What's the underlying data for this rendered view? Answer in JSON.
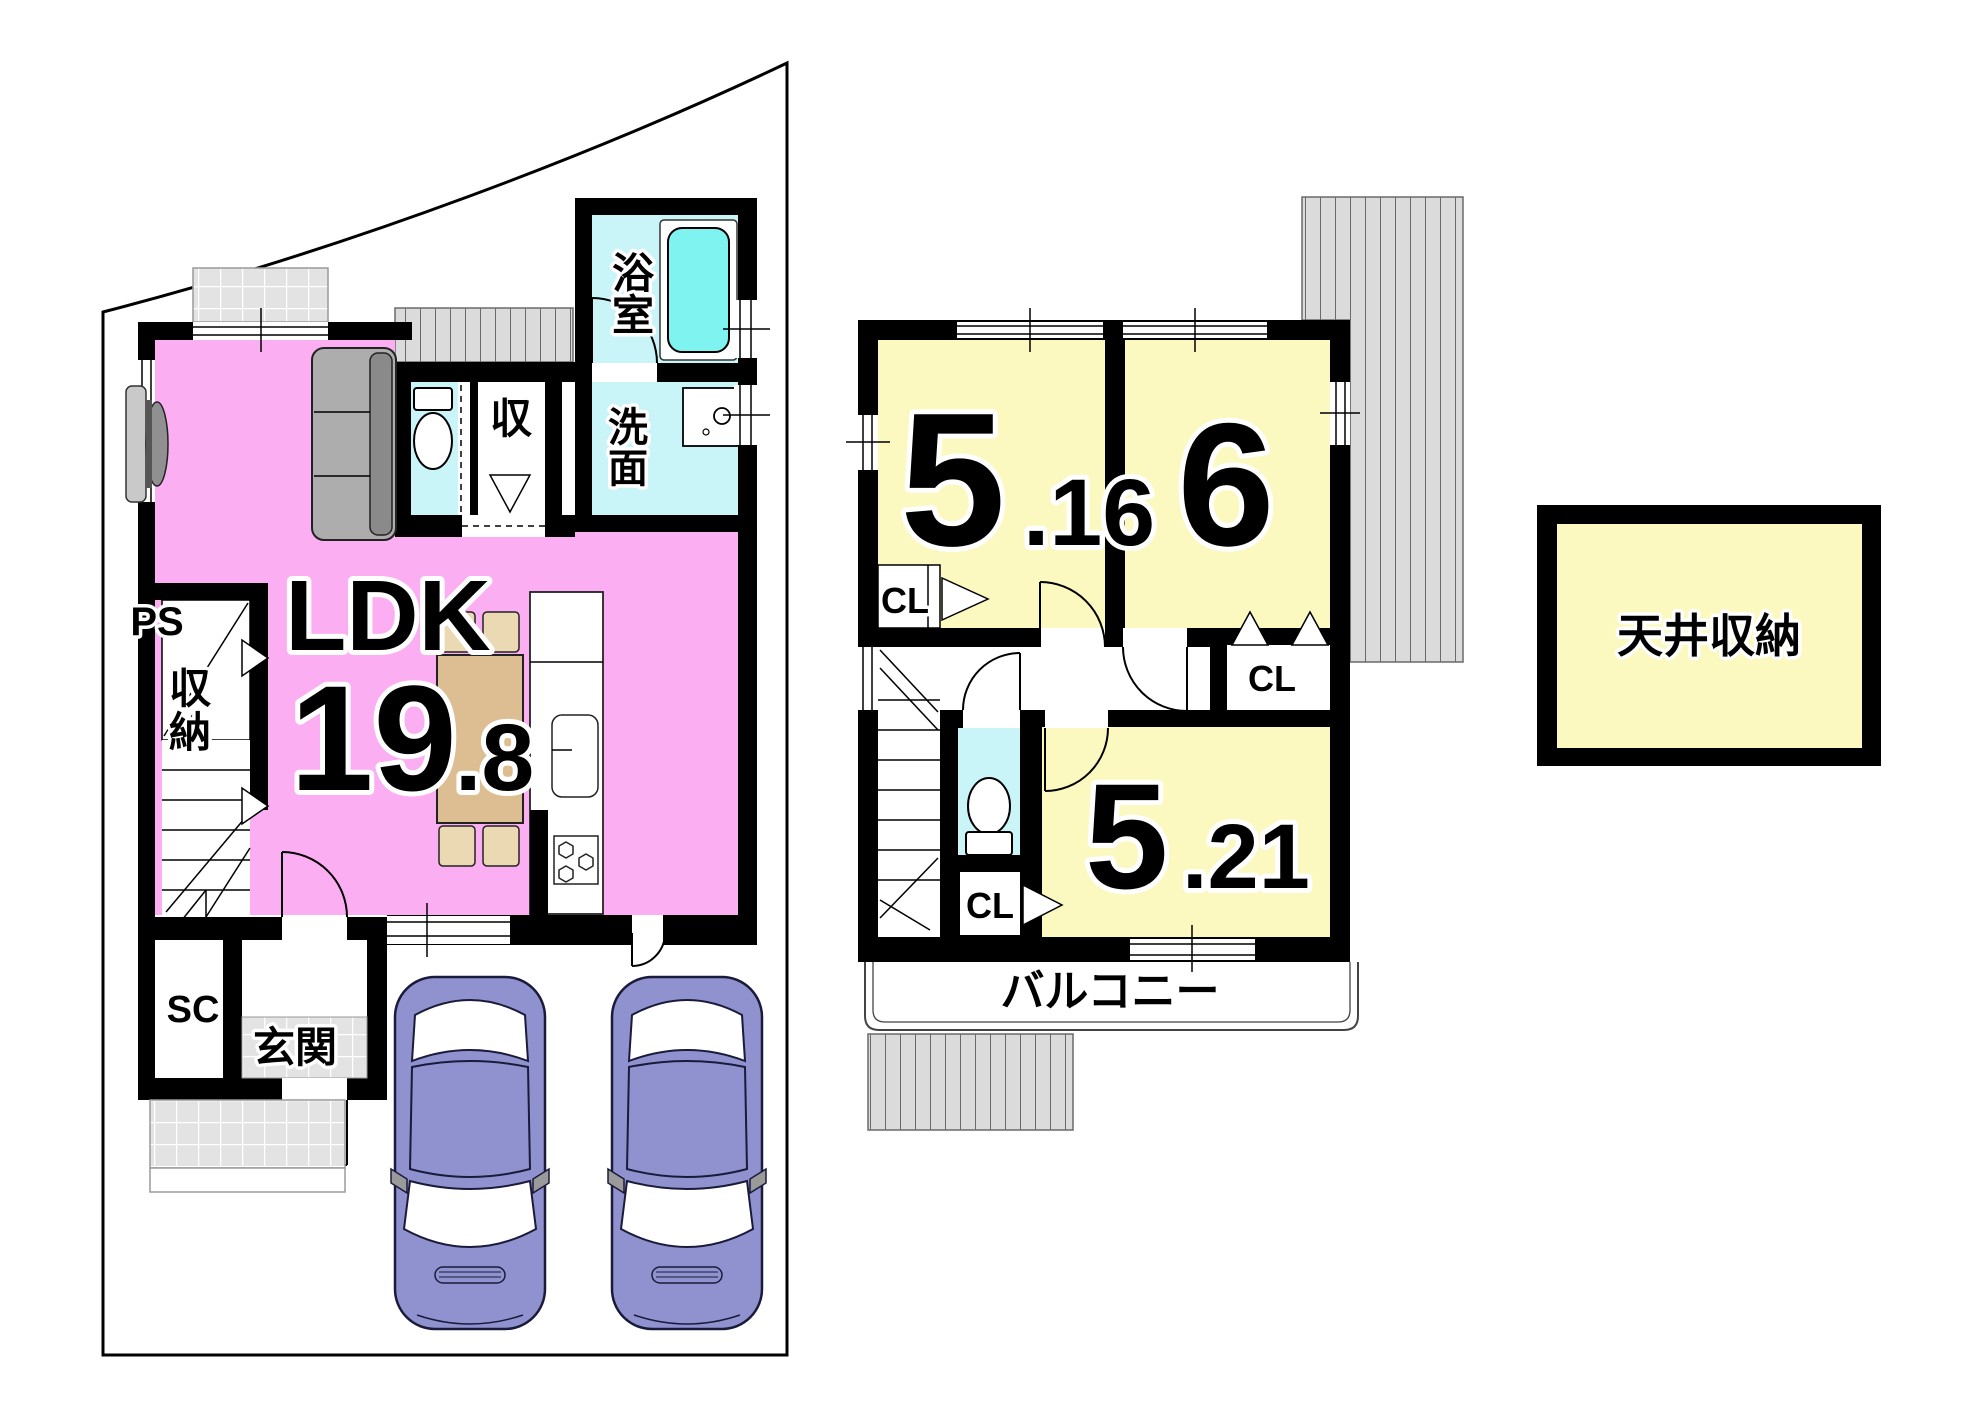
{
  "colors": {
    "ldk_pink": "#FBAEF2",
    "room_yellow": "#FBF8C0",
    "wet_cyan": "#C9F4F8",
    "tub_aqua": "#7EF3EF",
    "tile_gray": "#E3E3E3",
    "roof_stripe": "#DBDBDB",
    "car_body": "#8F92CE",
    "sofa_gray": "#ADADAD",
    "sofa_back_gray": "#8A8A8A",
    "table_tan": "#DDBE92",
    "chair_tan": "#EBD9B4"
  },
  "floor1": {
    "ldk": {
      "label": "LDK",
      "area_int": "19",
      "area_frac": ".8"
    },
    "bathroom": {
      "label_line1": "浴",
      "label_line2": "室"
    },
    "washroom": {
      "label_line1": "洗",
      "label_line2": "面"
    },
    "hall_closet": {
      "label": "収"
    },
    "pipe_space": {
      "label": "PS"
    },
    "under_stair_storage": {
      "label_line1": "収",
      "label_line2": "納"
    },
    "shoe_closet": {
      "label": "SC"
    },
    "entrance": {
      "label": "玄関"
    }
  },
  "floor2": {
    "bedroom_a": {
      "area_int": "5",
      "area_frac": ".16"
    },
    "bedroom_b": {
      "area_int": "6"
    },
    "bedroom_c": {
      "area_int": "5",
      "area_frac": ".21"
    },
    "closet_a": {
      "label": "CL"
    },
    "closet_b": {
      "label": "CL"
    },
    "closet_c": {
      "label": "CL"
    },
    "balcony": {
      "label": "バルコニー"
    }
  },
  "attic": {
    "label": "天井収納"
  }
}
